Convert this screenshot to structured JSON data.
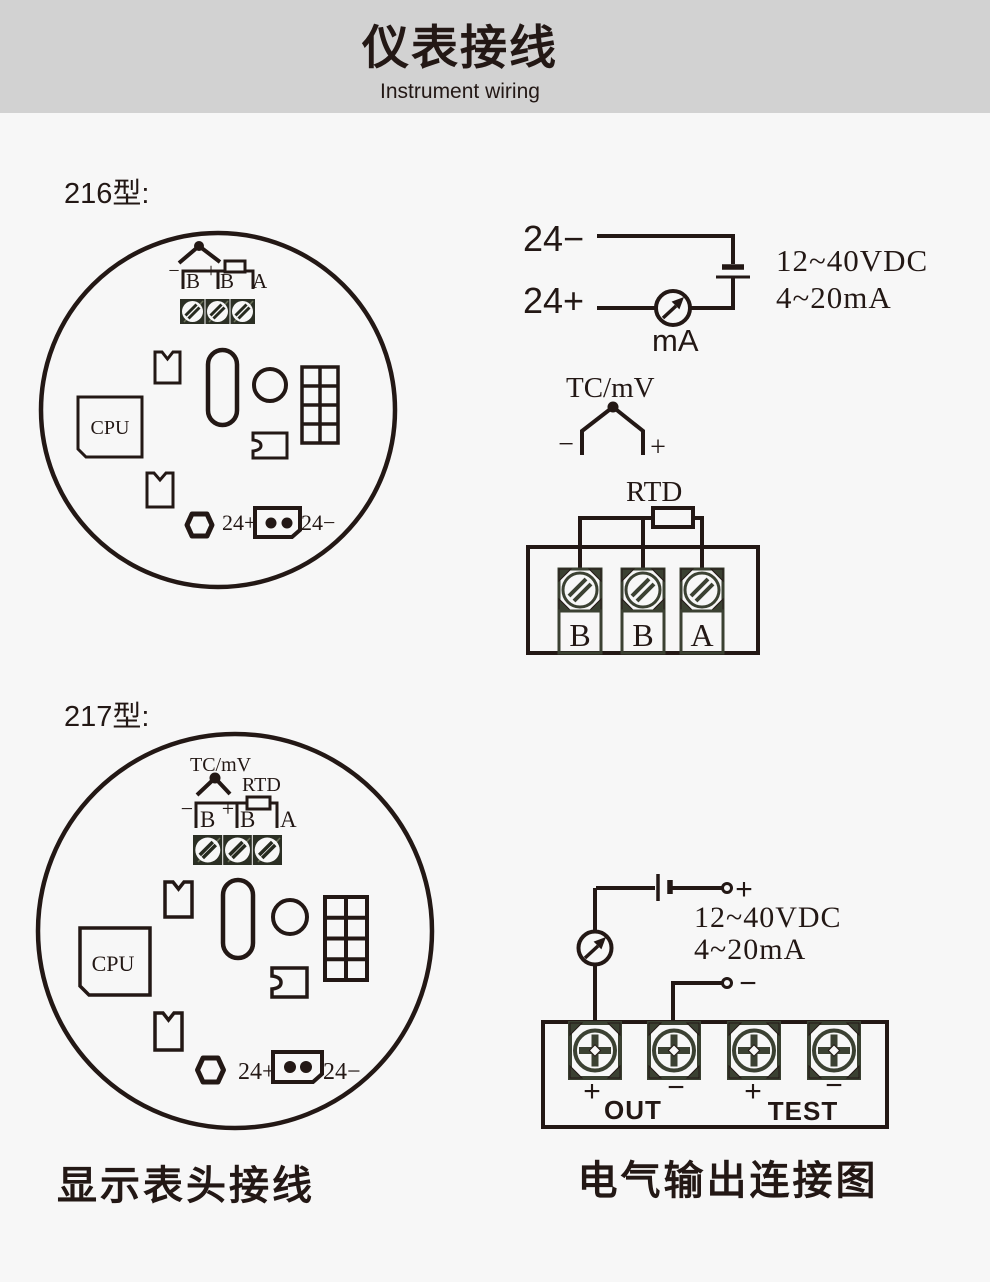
{
  "header": {
    "title": "仪表接线",
    "subtitle": "Instrument wiring"
  },
  "colors": {
    "page_bg": "#f7f7f7",
    "header_bg": "#d2d2d2",
    "line": "#231815",
    "terminal_green": "#3b4132"
  },
  "model216": {
    "label": "216型:",
    "pcb": {
      "cpu": "CPU",
      "tb_minus": "−",
      "tb_plus": "+",
      "tb_b1": "B",
      "tb_b2": "B",
      "tb_a": "A",
      "pwr_plus": "24+",
      "pwr_minus": "24−"
    },
    "loop": {
      "neg": "24−",
      "pos": "24+",
      "meter": "mA",
      "spec_v": "12~40VDC",
      "spec_i": "4~20mA"
    },
    "sensor": {
      "tc_label": "TC/mV",
      "tc_minus": "−",
      "tc_plus": "+",
      "rtd_label": "RTD",
      "t1": "B",
      "t2": "B",
      "t3": "A"
    }
  },
  "model217": {
    "label": "217型:",
    "pcb": {
      "tc_label": "TC/mV",
      "rtd_label": "RTD",
      "cpu": "CPU",
      "tb_minus": "−",
      "tb_plus": "+",
      "tb_b1": "B",
      "tb_b2": "B",
      "tb_a": "A",
      "pwr_plus": "24+",
      "pwr_minus": "24−"
    },
    "output": {
      "bat_plus": "+",
      "bat_minus": "−",
      "spec_v": "12~40VDC",
      "spec_i": "4~20mA",
      "out_plus": "+",
      "out_label": "OUT",
      "out_minus": "−",
      "test_plus": "+",
      "test_label": "TEST",
      "test_minus": "−"
    }
  },
  "captions": {
    "left": "显示表头接线",
    "right": "电气输出连接图"
  }
}
